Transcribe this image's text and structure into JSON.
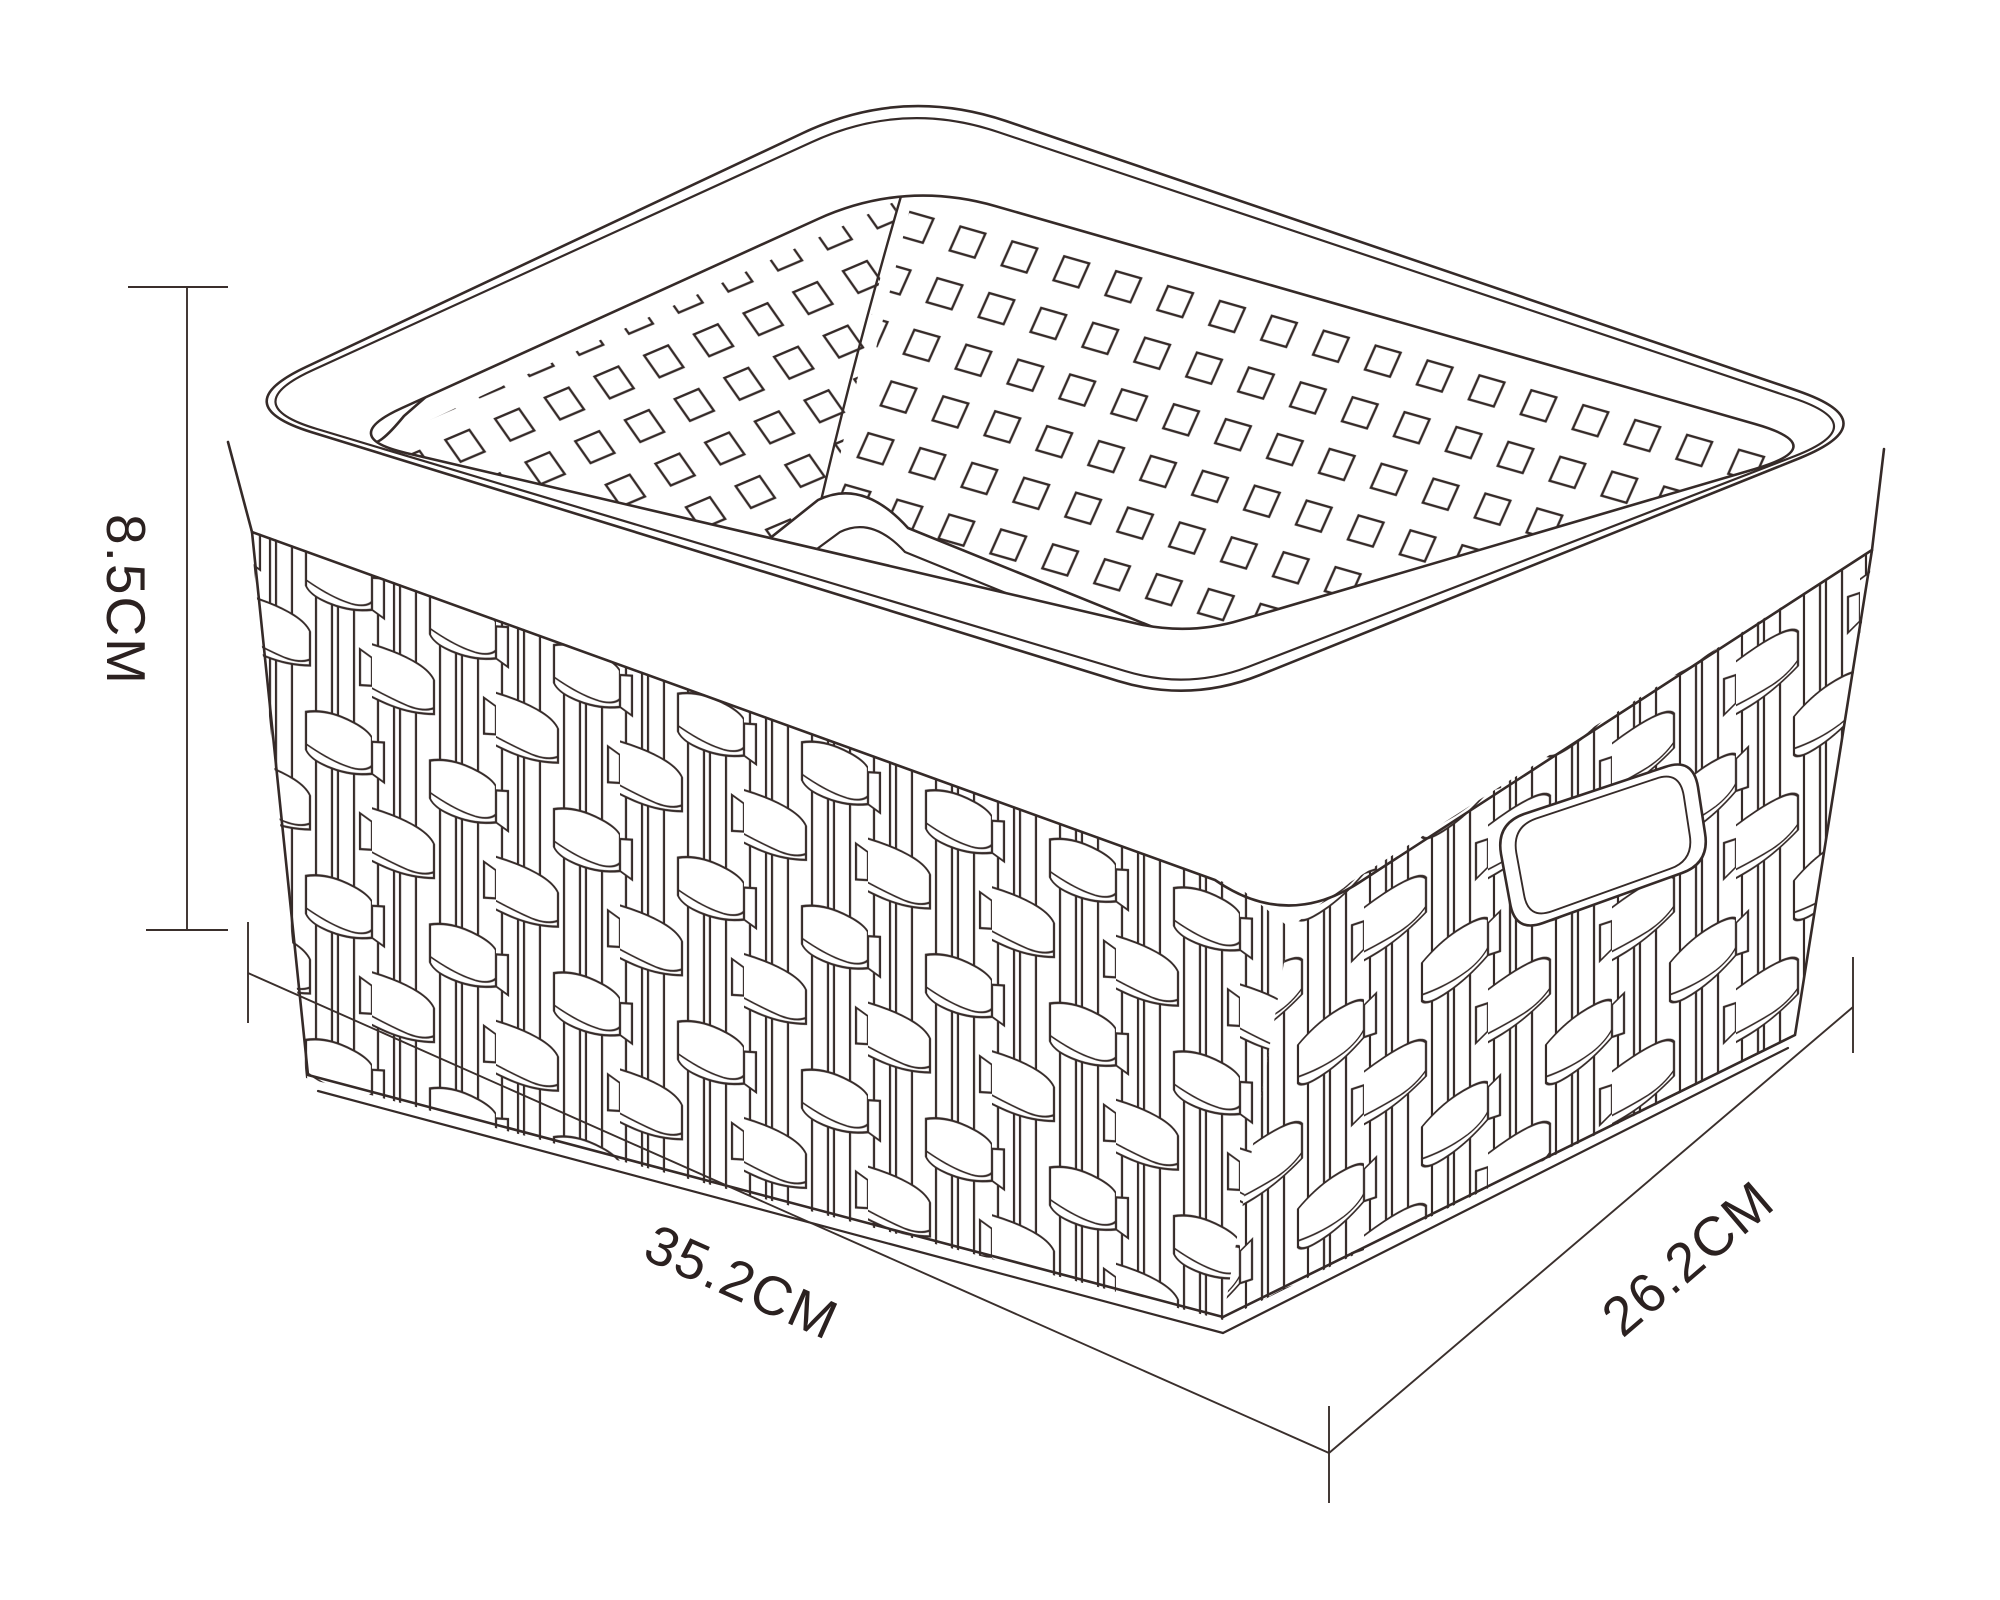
{
  "figure": {
    "type": "technical line drawing",
    "subject": "woven rattan-style rectangular storage basket, three-quarter top view",
    "style": "dark outline on white"
  },
  "dimensions": {
    "height": {
      "label": "8.5CM",
      "value": "8.5",
      "unit": "CM"
    },
    "width": {
      "label": "35.2CM",
      "value": "35.2",
      "unit": "CM"
    },
    "depth": {
      "label": "26.2CM",
      "value": "26.2",
      "unit": "CM"
    }
  },
  "colors": {
    "line": "#352a28",
    "text": "#2b2120",
    "background": "#ffffff"
  }
}
